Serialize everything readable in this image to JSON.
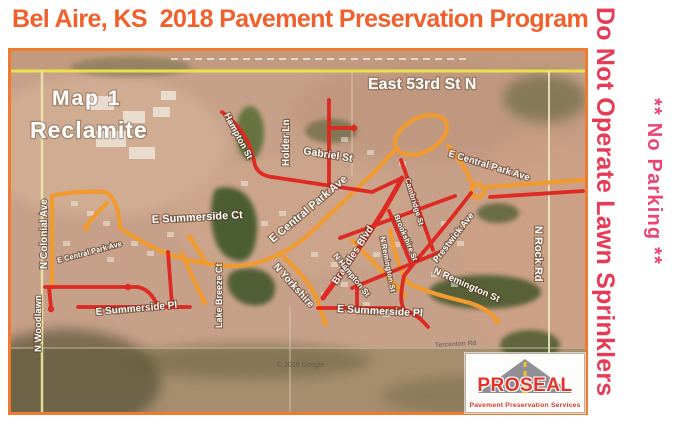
{
  "title": "Bel Aire, KS  2018 Pavement Preservation Program",
  "side_warnings": {
    "sprinklers": "Do Not Operate Lawn Sprinklers",
    "no_parking": "** No Parking **"
  },
  "map": {
    "name_label": "Map 1",
    "treatment_label": "Reclamite",
    "watermark": "© 2018 Google",
    "street_labels": [
      {
        "id": "east-53rd-st-n",
        "text": "East 53rd St N"
      },
      {
        "id": "hampton-st",
        "text": "Hampton St"
      },
      {
        "id": "holder-ln",
        "text": "Holder Ln"
      },
      {
        "id": "gabriel-st",
        "text": "Gabriel St"
      },
      {
        "id": "e-central-park-ave-mid",
        "text": "E Central Park Ave"
      },
      {
        "id": "e-central-park-ave-ne",
        "text": "E Central Park Ave"
      },
      {
        "id": "e-central-park-ave-w",
        "text": "E Central Park Ave"
      },
      {
        "id": "n-colonial-ave",
        "text": "N Colonial Ave"
      },
      {
        "id": "n-woodlawn",
        "text": "N Woodlawn"
      },
      {
        "id": "e-summerside-ct",
        "text": "E Summerside Ct"
      },
      {
        "id": "lake-breeze-ct",
        "text": "Lake Breeze Ct"
      },
      {
        "id": "n-yorkshire",
        "text": "N Yorkshire"
      },
      {
        "id": "e-summerside-pl-west",
        "text": "E Summerside Pl"
      },
      {
        "id": "e-summerside-pl-east",
        "text": "E Summerside Pl"
      },
      {
        "id": "cambridge-st",
        "text": "Cambridge St"
      },
      {
        "id": "brookshire-st",
        "text": "Brookshire St"
      },
      {
        "id": "brandles-blvd",
        "text": "Brandles Blvd"
      },
      {
        "id": "n-remington-st-mid",
        "text": "N Remington St"
      },
      {
        "id": "n-hampton-st",
        "text": "N Hampton St"
      },
      {
        "id": "prestwick-ave",
        "text": "Prestwick Ave"
      },
      {
        "id": "n-remington-st-east",
        "text": "N Remington St"
      },
      {
        "id": "n-rock-rd",
        "text": "N Rock Rd"
      },
      {
        "id": "tercenton-rd",
        "text": "Tercenton Rd"
      }
    ]
  },
  "logo": {
    "brand": "PROSEAL",
    "tagline": "Pavement Preservation Services"
  },
  "colors": {
    "title_orange": "#f1602c",
    "warning_red": "#e73b55",
    "map_border": "#ee7b31",
    "road_orange": "#f09a2f",
    "road_red": "#dd2a22",
    "road_yellow": "#e9e04e",
    "logo_red": "#e53228"
  }
}
